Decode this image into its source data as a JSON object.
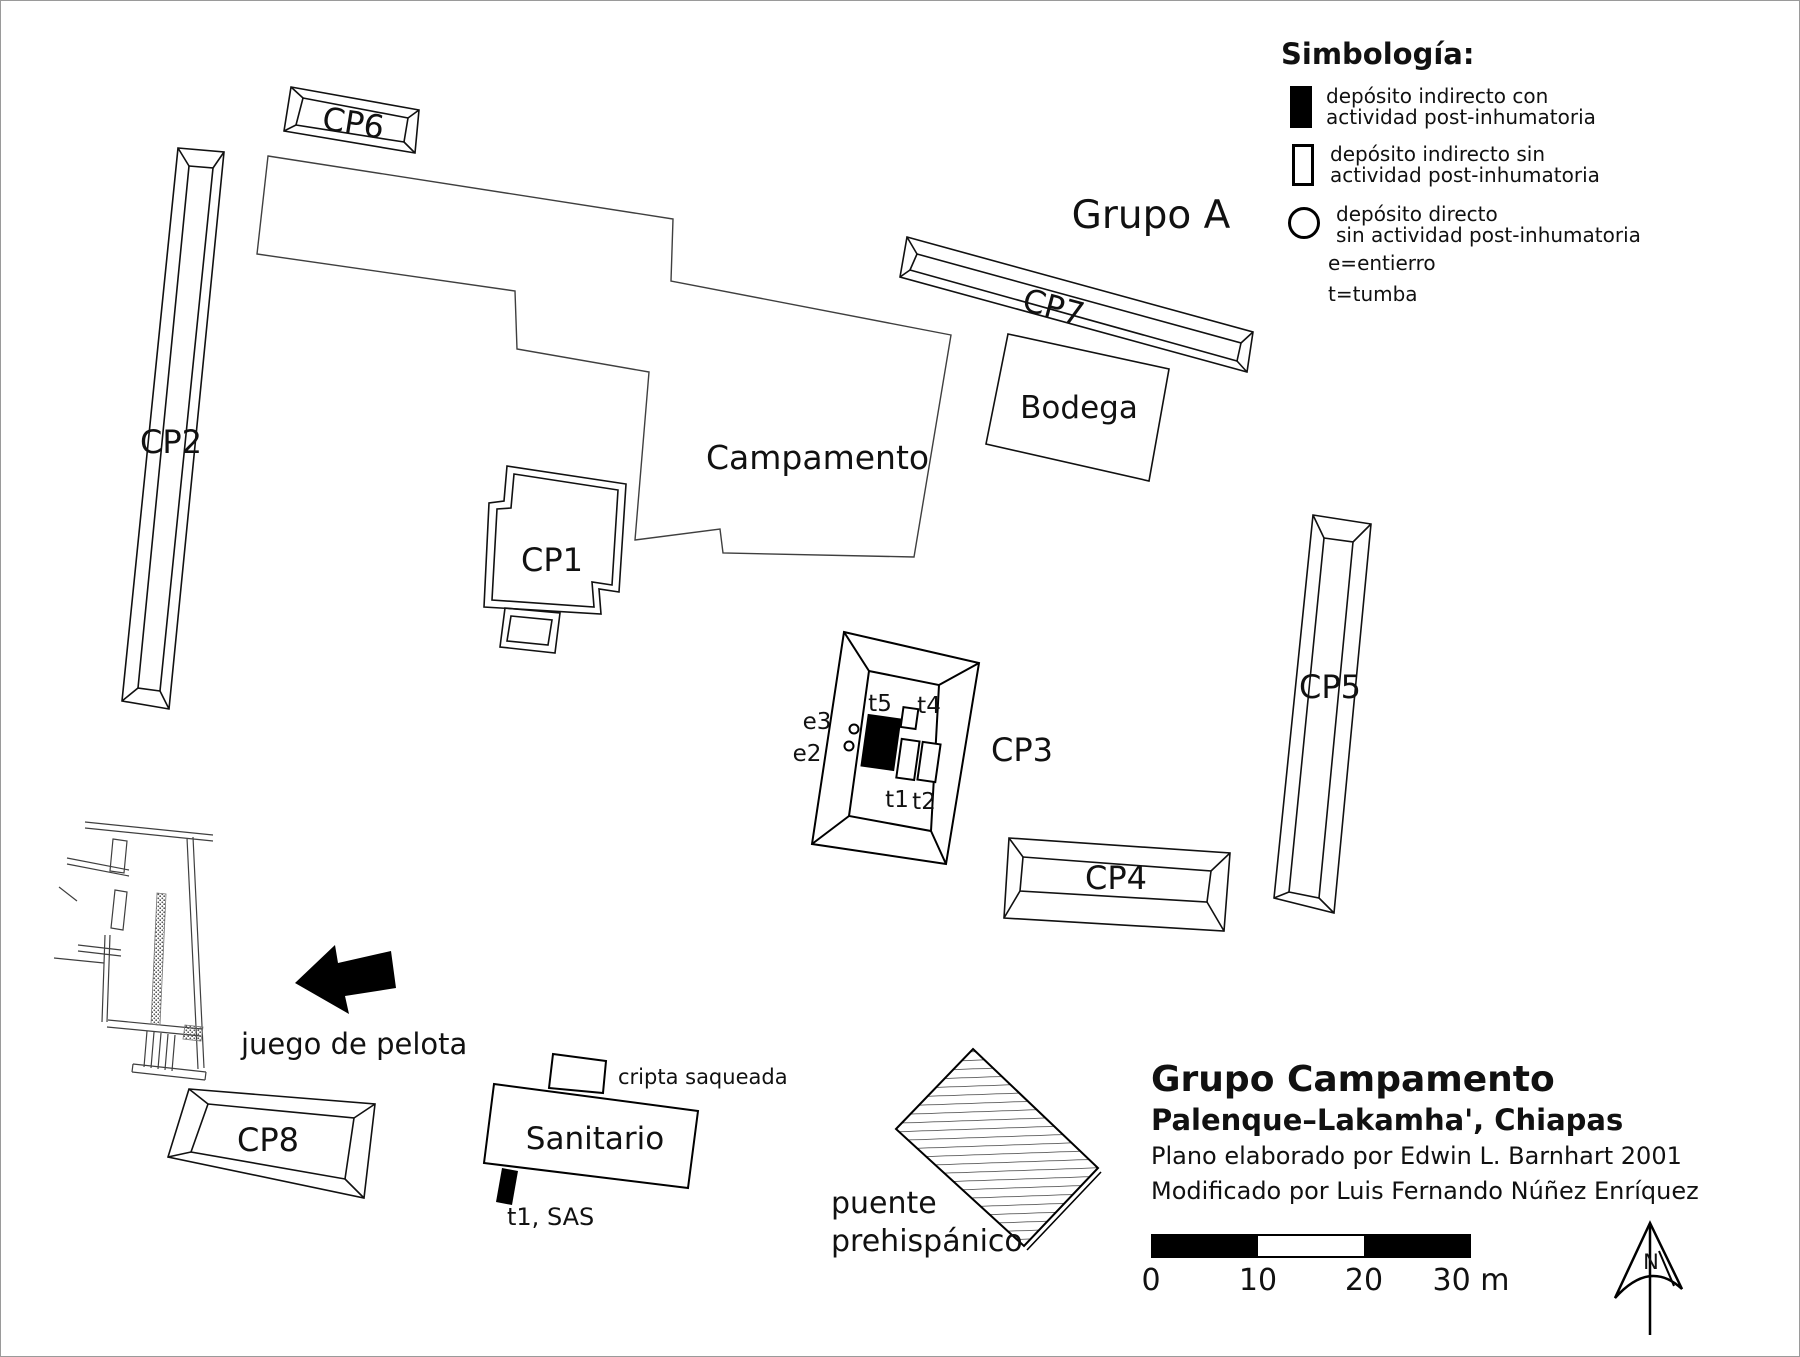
{
  "legend": {
    "title": "Simbología:",
    "items": [
      {
        "symbol": "filled-rect",
        "line1": "depósito indirecto con",
        "line2": "actividad post-inhumatoria"
      },
      {
        "symbol": "hollow-rect",
        "line1": "depósito indirecto sin",
        "line2": "actividad post-inhumatoria"
      },
      {
        "symbol": "circle",
        "line1": "depósito directo",
        "line2": "sin actividad post-inhumatoria"
      }
    ],
    "entierro": "e=entierro",
    "tumba": "t=tumba"
  },
  "map": {
    "structures": {
      "cp1": "CP1",
      "cp2": "CP2",
      "cp3": "CP3",
      "cp4": "CP4",
      "cp5": "CP5",
      "cp6": "CP6",
      "cp7": "CP7",
      "cp8": "CP8",
      "campamento": "Campamento",
      "bodega": "Bodega",
      "grupo_a": "Grupo A",
      "sanitario": "Sanitario"
    },
    "annotations": {
      "cripta": "cripta saqueada",
      "t1_sas": "t1, SAS",
      "juego": "juego de pelota",
      "puente_line1": "puente",
      "puente_line2": "prehispánico"
    },
    "burials": {
      "t5": "t5",
      "t4": "t4",
      "t1": "t1",
      "t2": "t2",
      "e2": "e2",
      "e3": "e3"
    }
  },
  "title_block": {
    "line1": "Grupo Campamento",
    "line2": "Palenque–Lakamha', Chiapas",
    "line3": "Plano elaborado por Edwin L. Barnhart 2001",
    "line4": "Modificado por Luis Fernando Núñez Enríquez"
  },
  "scale_bar": {
    "labels": [
      "0",
      "10",
      "20",
      "30 m"
    ]
  },
  "north": {
    "label": "N"
  },
  "colors": {
    "ink": "#111111",
    "thin_line": "#3f3f3f",
    "paper": "#ffffff"
  }
}
